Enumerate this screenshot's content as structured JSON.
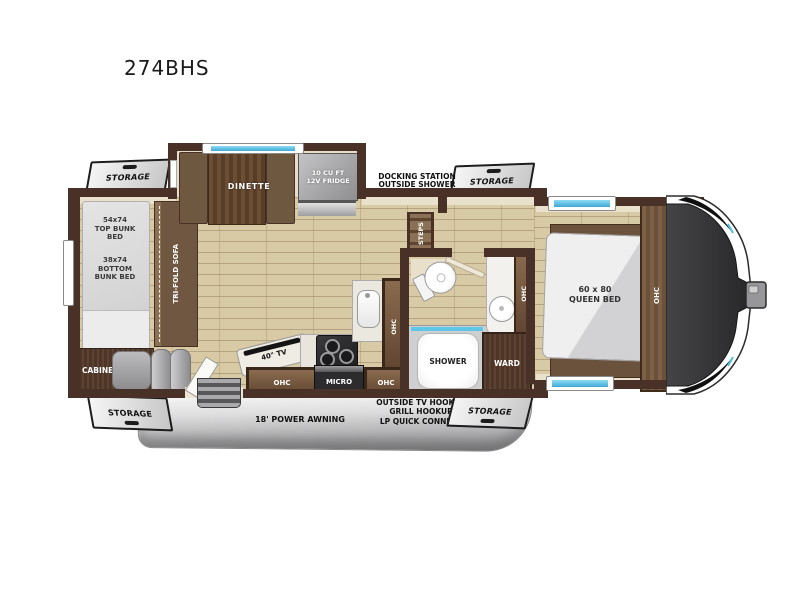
{
  "title": "274BHS",
  "labels": {
    "storage": "STORAGE",
    "docking": "DOCKING STATION\nOUTSIDE SHOWER",
    "dinette": "DINETTE",
    "fridge": "10 CU FT\n12V FRIDGE",
    "steps": "STEPS",
    "top_bunk": "54x74\nTOP BUNK\nBED",
    "bottom_bunk": "38x74\nBOTTOM\nBUNK BED",
    "sofa": "TRI-FOLD SOFA",
    "cabinet": "CABINET",
    "tv": "40\" TV",
    "ohc": "OHC",
    "micro": "MICRO",
    "shower": "SHOWER",
    "ward": "WARD",
    "queen_bed": "60 x 80\nQUEEN BED",
    "awning": "18' POWER AWNING",
    "hookups": "OUTSIDE TV HOOKUP\nGRILL HOOKUP\nLP QUICK CONNECT"
  },
  "colors": {
    "wall": "#4a3128",
    "floor": "#d8caa4",
    "window": "#5ec7e9",
    "wood_dark": "#4e3526",
    "wood_mid": "#6b523c",
    "cap": "#353537",
    "flap": "#e4e4e4"
  }
}
